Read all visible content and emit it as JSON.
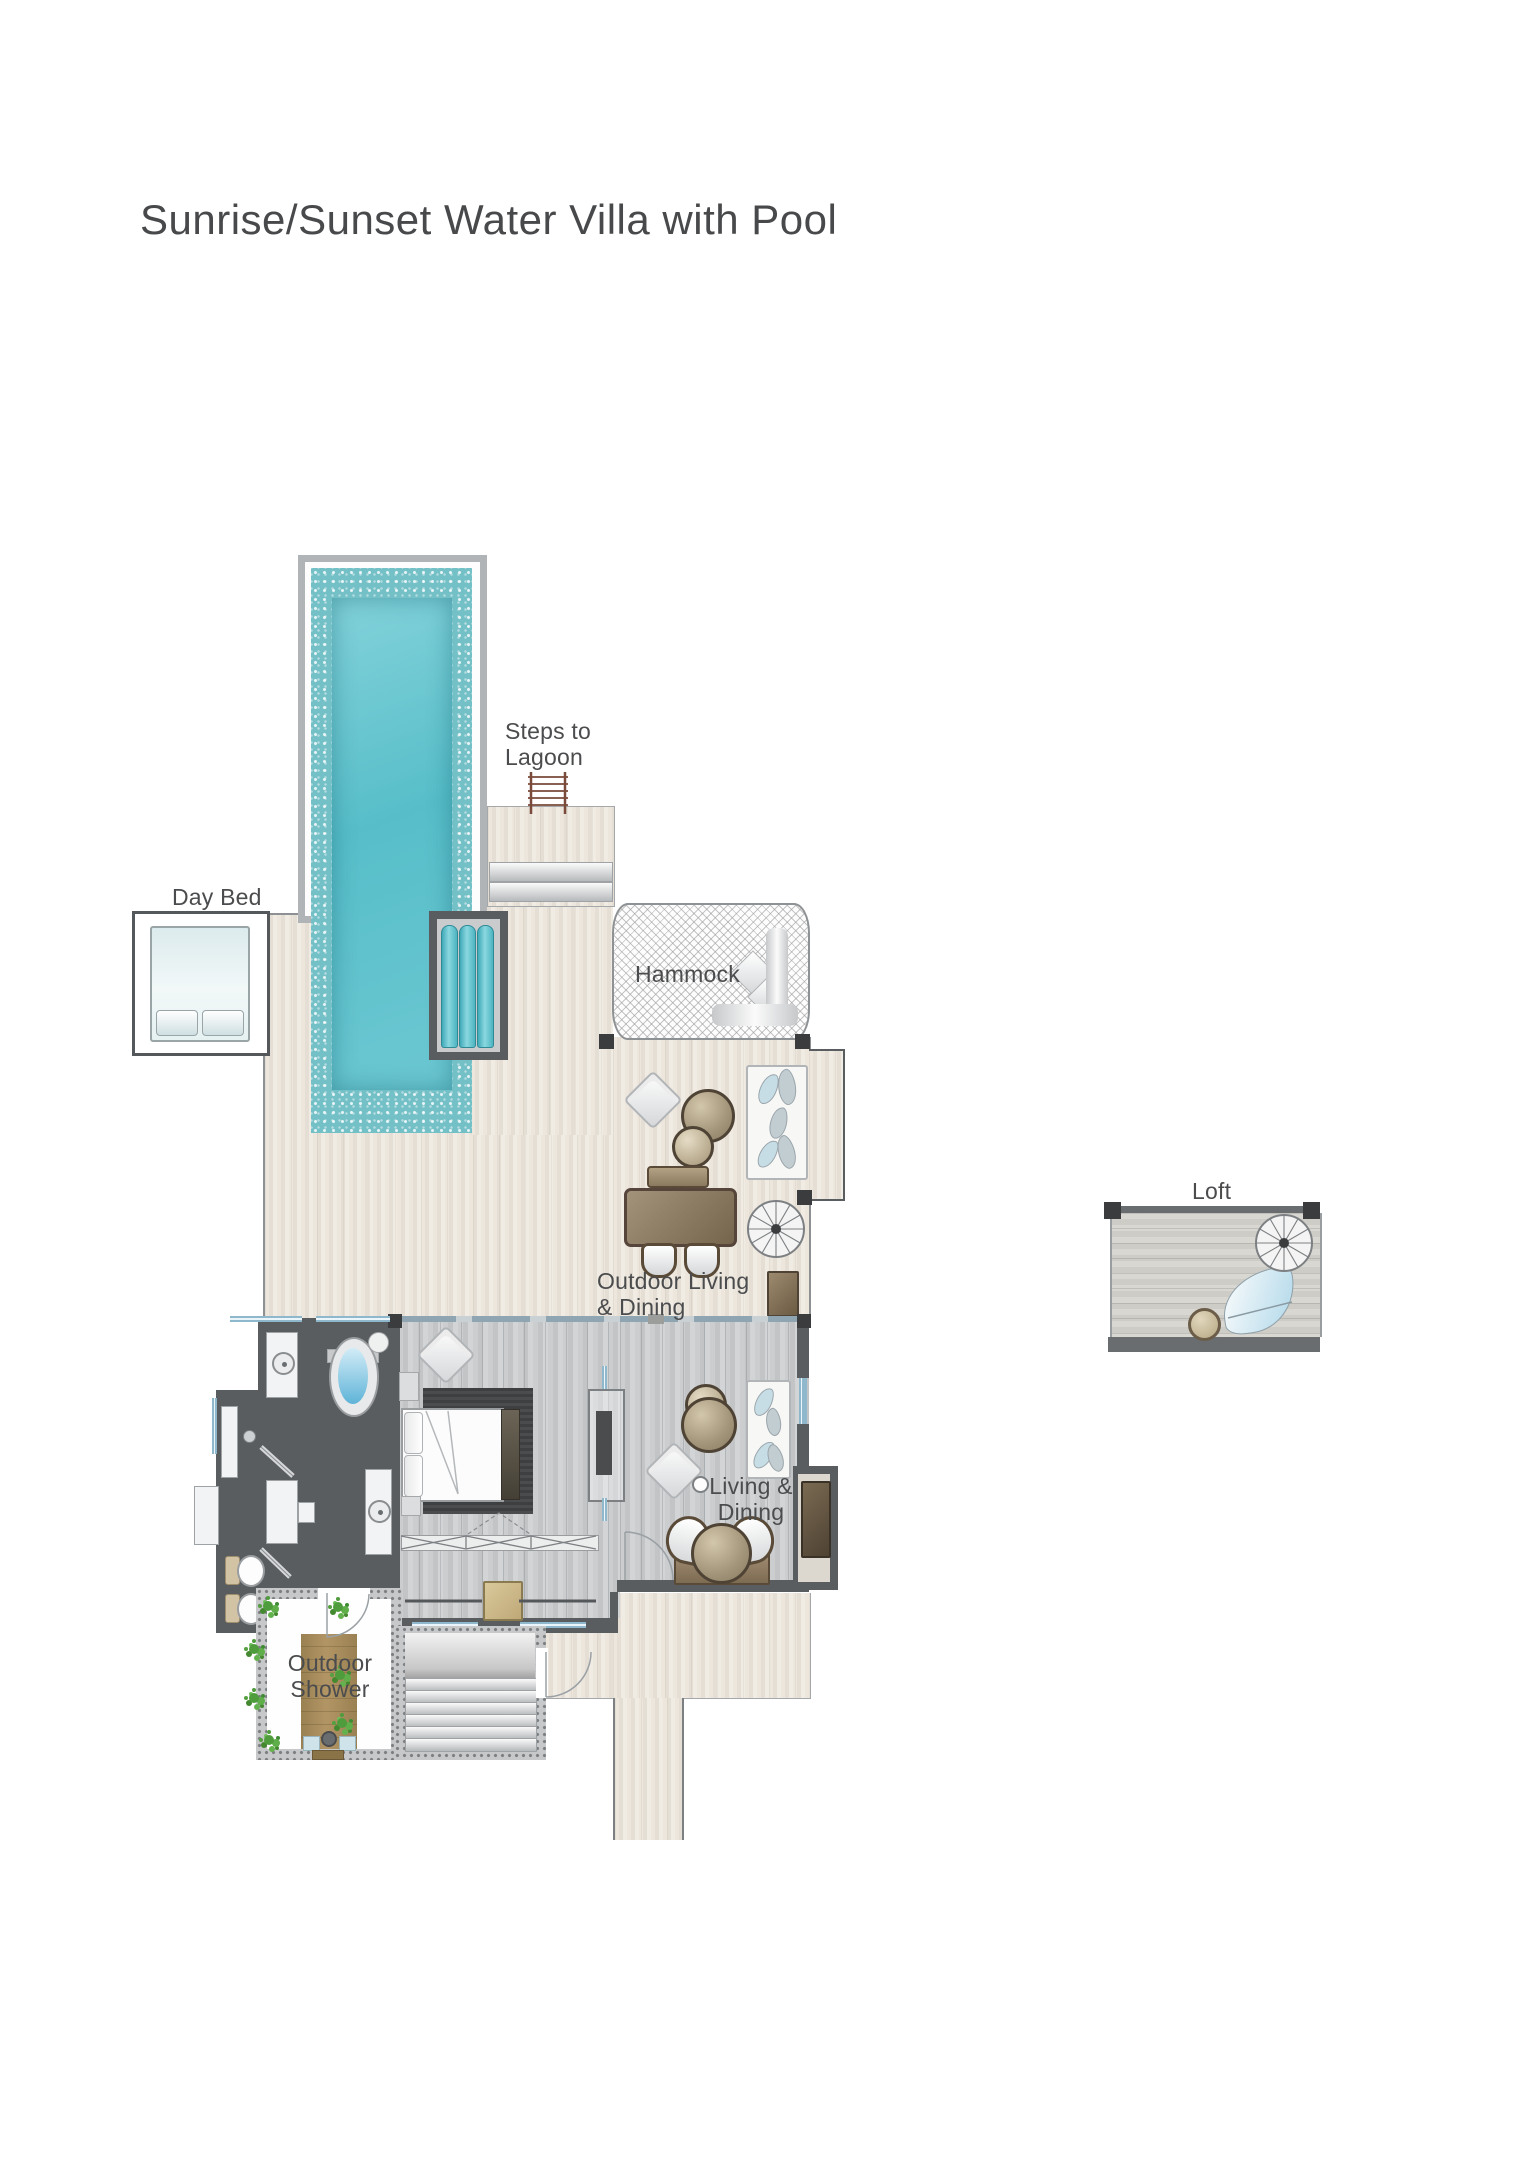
{
  "title": "Sunrise/Sunset Water Villa with Pool",
  "labels": {
    "day_bed": "Day Bed",
    "steps_to_lagoon": "Steps to\nLagoon",
    "hammock": "Hammock",
    "outdoor_living_dining": "Outdoor Living\n& Dining",
    "loft": "Loft",
    "living_dining": "Living &\nDining",
    "outdoor_shower": "Outdoor\nShower"
  },
  "colors": {
    "pool_water": "#5fc3ce",
    "pool_tile": "#74c0c7",
    "pool_surround": "#b1b4b7",
    "deck_wood": "#e9e3da",
    "interior_floor": "#c8cacc",
    "wall_dark": "#5a5d60",
    "window_blue": "#a9cfe3",
    "furniture_brown": "#8a7a5f",
    "bench_tan": "#cbb987",
    "plant_green": "#55a041",
    "label_text": "#4b4c4e"
  }
}
